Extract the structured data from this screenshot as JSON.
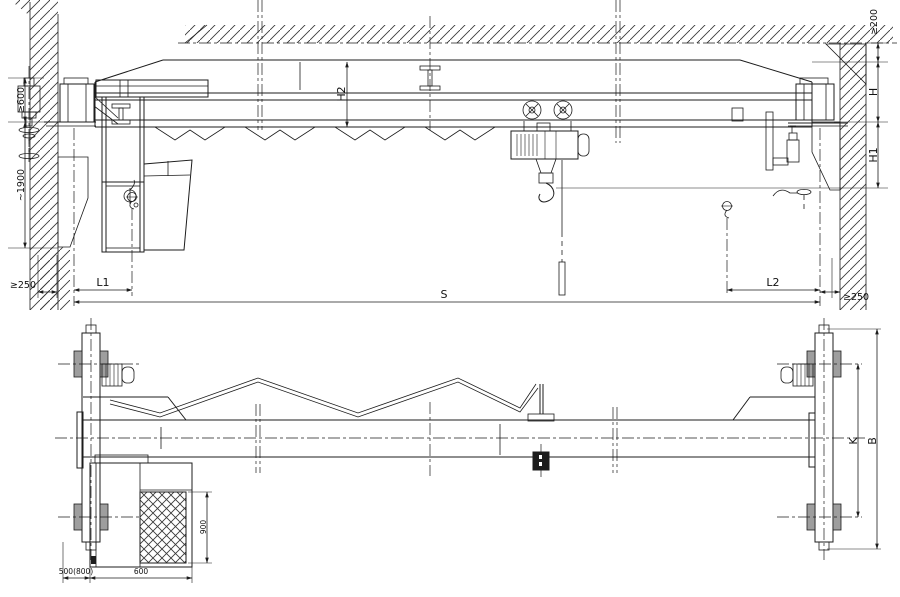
{
  "drawing": {
    "kind": "single-girder overhead crane general arrangement",
    "views": {
      "elevation": {
        "labels": {
          "min600": "≥600",
          "approx1900": "~1900",
          "min250_left": "≥250",
          "min250_right": "≥250",
          "min200": "≥200",
          "L1": "L1",
          "L2": "L2",
          "S": "S",
          "H": "H",
          "H1": "H1",
          "H2": "H2"
        }
      },
      "plan": {
        "labels": {
          "d500_800": "500(800)",
          "d600": "600",
          "d900": "900",
          "K": "K",
          "B": "B"
        }
      }
    },
    "colors": {
      "line": "#1c1c1c",
      "background": "#ffffff",
      "wheel_fill": "#9e9e9e",
      "pendant_fill": "#1c1c1c"
    }
  }
}
